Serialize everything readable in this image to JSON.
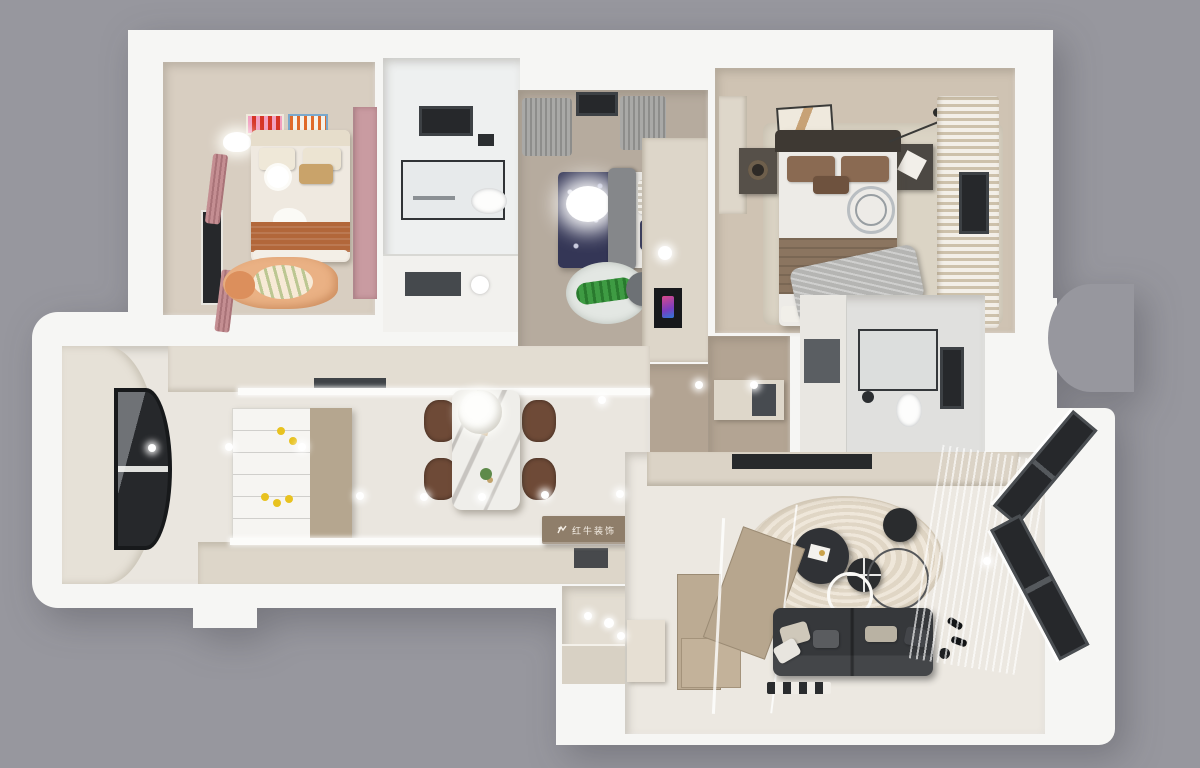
{
  "scene": {
    "type": "3d-floor-plan-render",
    "view": "top-down axonometric",
    "background": "#97979e"
  },
  "watermark": {
    "text": "红牛装饰",
    "logo": "bull-icon"
  },
  "palette": {
    "bg": "#97979e",
    "wall": "#f6f6f4",
    "wall_shade": "#e3e2de",
    "floor_kids": "#d8cec1",
    "floor_bath": "#eef0f0",
    "floor_boys": "#b6ab9e",
    "floor_master": "#cfc3b3",
    "floor_hall": "#b3a493",
    "floor_kitchen": "#eae6df",
    "floor_living": "#ece8e1",
    "pink": "#c99ba1",
    "navy": "#343656",
    "sofa": "#36383b",
    "stair_wood": "#bcab93",
    "chair_brown": "#6e4a37",
    "counter": "#e3ddd2",
    "cream_cab": "#ded7ca",
    "dark_glass": "#26282b",
    "rug_cream": "#e6ddd0",
    "lemon": "#e8c21f",
    "orange_blanket": "#b2673a",
    "throw_gray": "#b5b5b3",
    "plaque": "#8f7e6a"
  },
  "rooms": [
    {
      "id": "kids-bedroom",
      "name": "Children's Bedroom",
      "key_items": [
        "single bed",
        "orange blanket",
        "fox rug",
        "two wall posters",
        "cloud wall lamp",
        "pink wardrobe",
        "pink curtains",
        "window"
      ]
    },
    {
      "id": "bathroom-1",
      "name": "Bathroom",
      "key_items": [
        "skylight window",
        "shower enclosure",
        "shower head",
        "toilet",
        "towel rail",
        "vanity counter"
      ]
    },
    {
      "id": "boys-bedroom",
      "name": "Boy's Bedroom",
      "key_items": [
        "bed with space-print duvet",
        "glowing cloud lamp",
        "gray throw",
        "crocodile rug",
        "desk unit",
        "desk chair",
        "gray curtains",
        "window"
      ]
    },
    {
      "id": "master-bedroom",
      "name": "Master Bedroom",
      "key_items": [
        "double bed",
        "dark headboard",
        "metal ring decor",
        "gray throw",
        "two nightstands",
        "wall art",
        "area rug",
        "floor lamp",
        "striped curtains",
        "window"
      ]
    },
    {
      "id": "hallway",
      "name": "Hallway",
      "key_items": [
        "wood floor",
        "doormat",
        "wardrobe cabinet",
        "recessed ceiling lights"
      ]
    },
    {
      "id": "bathroom-2",
      "name": "En-suite Bathroom",
      "key_items": [
        "glass shower",
        "toilet",
        "vanity cabinet",
        "window"
      ]
    },
    {
      "id": "kitchen-dining",
      "name": "Kitchen & Dining",
      "key_items": [
        "curved bay window",
        "upper counter run",
        "lower counter run",
        "island with lemons",
        "range hood",
        "marble dining table",
        "four brown chairs",
        "round pendant light"
      ]
    },
    {
      "id": "living-room",
      "name": "Living Room",
      "key_items": [
        "charcoal sofa with cushions",
        "nested round coffee tables",
        "swirl-pattern round rug",
        "L-shaped wood staircase",
        "glass balustrade",
        "TV console",
        "angled bay windows",
        "sheer curtains",
        "floor lamp"
      ]
    },
    {
      "id": "entrance",
      "name": "Entrance Nook",
      "key_items": [
        "platform step",
        "shoe cabinet",
        "decor vase"
      ]
    }
  ]
}
